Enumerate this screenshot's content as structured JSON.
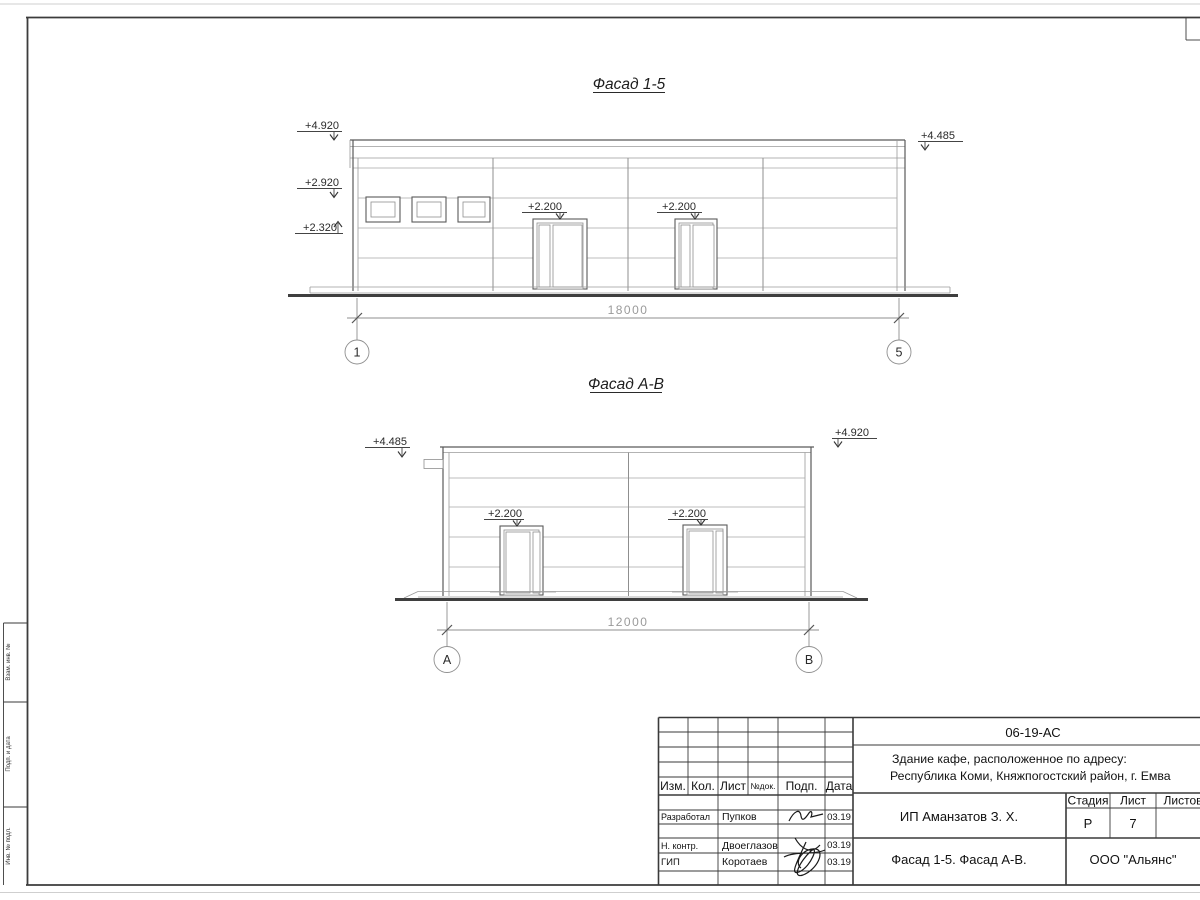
{
  "facade_15": {
    "title": "Фасад 1-5",
    "elev_top_left": "+4.920",
    "elev_mid_left": "+2.920",
    "elev_low_left": "+2.320",
    "elev_top_right": "+4.485",
    "elev_door1": "+2.200",
    "elev_door2": "+2.200",
    "dimension": "18000",
    "grid_left": "1",
    "grid_right": "5"
  },
  "facade_ab": {
    "title": "Фасад А-В",
    "elev_top_left": "+4.485",
    "elev_top_right": "+4.920",
    "elev_door1": "+2.200",
    "elev_door2": "+2.200",
    "dimension": "12000",
    "grid_left": "А",
    "grid_right": "В"
  },
  "title_block": {
    "doc_number": "06-19-АС",
    "project_line1": "Здание кафе, расположенное по адресу:",
    "project_line2": "Республика Коми, Княжпогостский район, г. Емва",
    "client": "ИП Аманзатов З. Х.",
    "drawing_title": "Фасад 1-5. Фасад А-В.",
    "company": "ООО \"Альянс\"",
    "stage_label": "Стадия",
    "sheet_label": "Лист",
    "sheets_label": "Листов",
    "stage": "Р",
    "sheet_number": "7",
    "rev_headers": {
      "izm": "Изм.",
      "kol": "Кол.",
      "list": "Лист",
      "ndoc": "№док.",
      "podp": "Подп.",
      "data": "Дата"
    },
    "signers": [
      {
        "role": "Разработал",
        "name": "Пупков",
        "date": "03.19"
      },
      {
        "role": "Н. контр.",
        "name": "Двоеглазов",
        "date": "03.19"
      },
      {
        "role": "ГИП",
        "name": "Коротаев",
        "date": "03.19"
      }
    ]
  },
  "side_strip": {
    "label1": "Взам. инв. №",
    "label2": "Подп. и дата",
    "label3": "Инв. № подл."
  }
}
